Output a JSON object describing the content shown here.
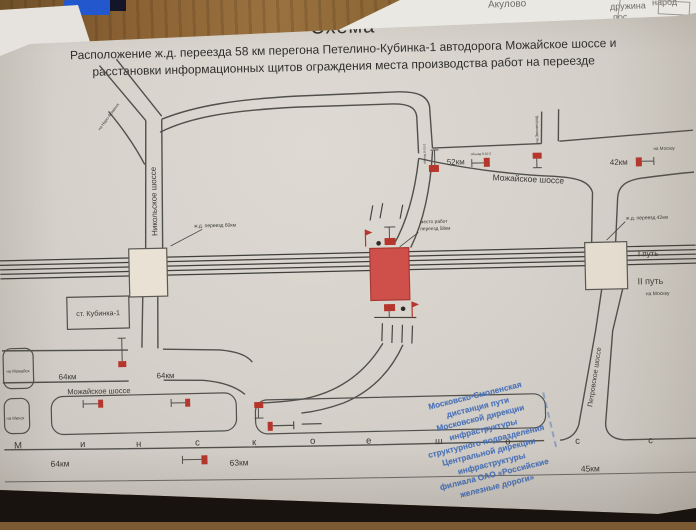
{
  "background_fragments": {
    "f1": "Акулово",
    "f2": "дружина",
    "f3": "пос",
    "f4": "народ"
  },
  "header": {
    "title": "Схема",
    "subtitle_line1": "Расположение ж.д. переезда 58 км перегона Петелино-Кубинка-1 автодорога Можайское шоссе и",
    "subtitle_line2": "расстановки информационных щитов ограждения места производства работ на переезде"
  },
  "diagram": {
    "roads": {
      "nikolskoye": "Никольское шоссе",
      "mozhayskoye_top": "Можайское шоссе",
      "mozhayskoye_bottom": "Можайское шоссе",
      "petrovskoye": "Петровское шоссе",
      "minskoye_letters": [
        "М",
        "и",
        "н",
        "с",
        "к",
        "о",
        "е",
        "ш",
        "о",
        "с",
        "с"
      ]
    },
    "crossings": {
      "left": "ж.д. переезд 60км",
      "center_line1": "место работ",
      "center_line2": "переезд 58км",
      "right": "ж.д. переезд 42км"
    },
    "station": "ст. Кубинка-1",
    "railway": {
      "track1": "I путь",
      "track2": "II путь",
      "to_moscow": "на Москву"
    },
    "km": {
      "k52": "52км",
      "k42": "42км",
      "k64a": "64км",
      "k64b": "64км",
      "k64c": "64км",
      "k63": "63км",
      "k45": "45км"
    },
    "directions": {
      "to_moscow_road": "на Москву",
      "to_zvenigorod": "на Звенигород",
      "to_mozhaysk": "на Можайск",
      "to_minsk": "на Минск",
      "to_naro_fominsk": "на Наро-Фоминск"
    },
    "notes": {
      "detour_top": "объезд 8-10-2",
      "detour_junction": "объезд 8-10-2"
    }
  },
  "stamp": {
    "lines": [
      "Московско-Смоленская",
      "дистанция пути",
      "Московской дирекции",
      "инфраструктуры",
      "структурного подразделения",
      "Центральной дирекции",
      "инфраструктуры",
      "филиала ОАО «Российские",
      "железные дороги»"
    ]
  },
  "colors": {
    "work_zone": "#cf4f4a",
    "sign_red": "#b5362c",
    "stamp_blue": "#3f6ab8"
  }
}
